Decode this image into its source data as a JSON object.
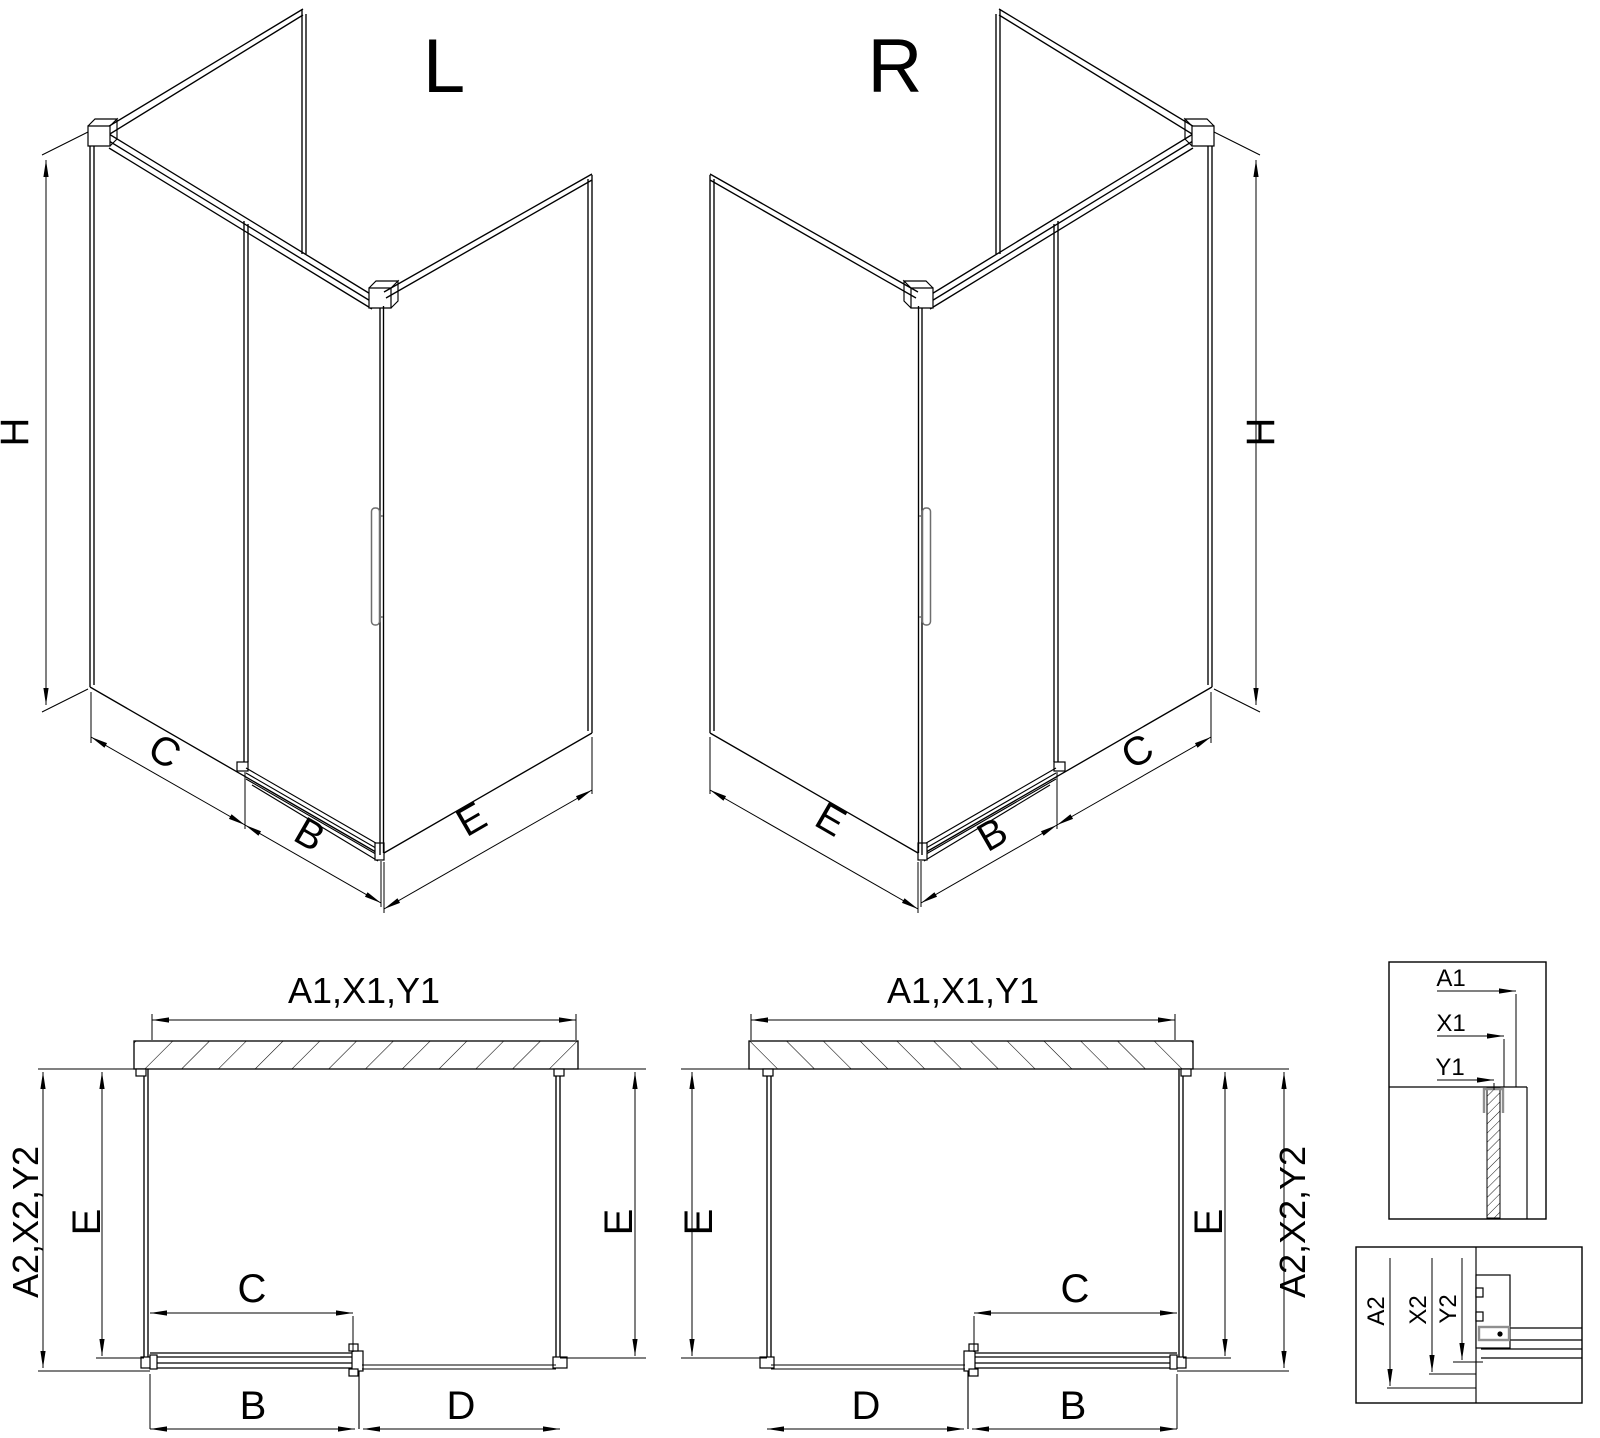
{
  "page": {
    "background": "#ffffff",
    "line_color": "#000000",
    "profile_gray": "#8f8f8f"
  },
  "iso_views": {
    "left": {
      "title": "L",
      "dim_height": "H",
      "dim_fixed": "C",
      "dim_door": "B",
      "dim_side": "E"
    },
    "right": {
      "title": "R",
      "dim_height": "H",
      "dim_fixed": "C",
      "dim_door": "B",
      "dim_side": "E"
    }
  },
  "plan_views": {
    "left": {
      "dim_top": "A1,X1,Y1",
      "dim_outer": "A2,X2,Y2",
      "dim_depth_left": "E",
      "dim_depth_right": "E",
      "dim_slide": "C",
      "dim_door": "B",
      "dim_open": "D"
    },
    "right": {
      "dim_top": "A1,X1,Y1",
      "dim_outer": "A2,X2,Y2",
      "dim_depth_left": "E",
      "dim_depth_right": "E",
      "dim_slide": "C",
      "dim_door": "B",
      "dim_open": "D"
    }
  },
  "details": {
    "top": {
      "labels": [
        "A1",
        "X1",
        "Y1"
      ]
    },
    "bottom": {
      "labels": [
        "A2",
        "X2",
        "Y2"
      ]
    }
  }
}
